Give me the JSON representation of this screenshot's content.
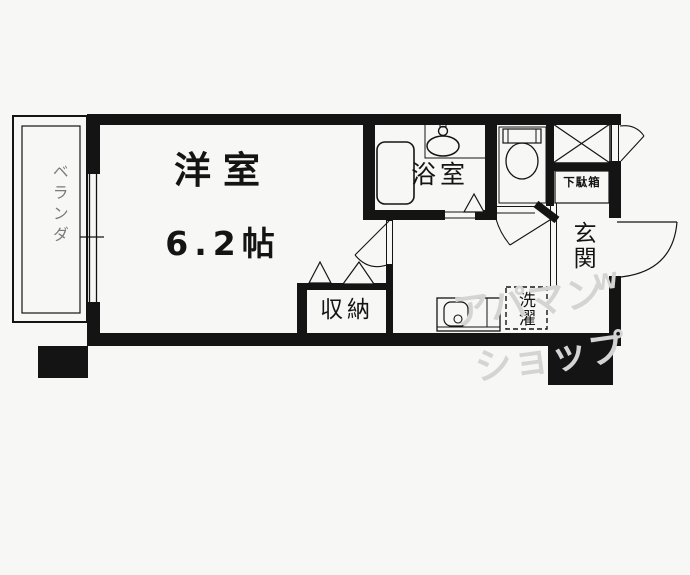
{
  "floorplan": {
    "main_room": {
      "name": "洋室",
      "size": "6.2帖"
    },
    "bathroom": {
      "name": "浴室"
    },
    "closet": {
      "name": "収納"
    },
    "entrance": {
      "name": "玄関"
    },
    "shoe_cabinet": {
      "name": "下駄箱"
    },
    "laundry": {
      "name": "洗濯"
    },
    "veranda": {
      "name": "ベランダ"
    }
  },
  "watermark": {
    "line1": "アパマン",
    "line2": "ショップ",
    "mark": "W"
  },
  "colors": {
    "line": "#141414",
    "background": "#f7f8f5",
    "watermark": "#d4d4d4",
    "veranda_text": "#7a7a7a"
  }
}
